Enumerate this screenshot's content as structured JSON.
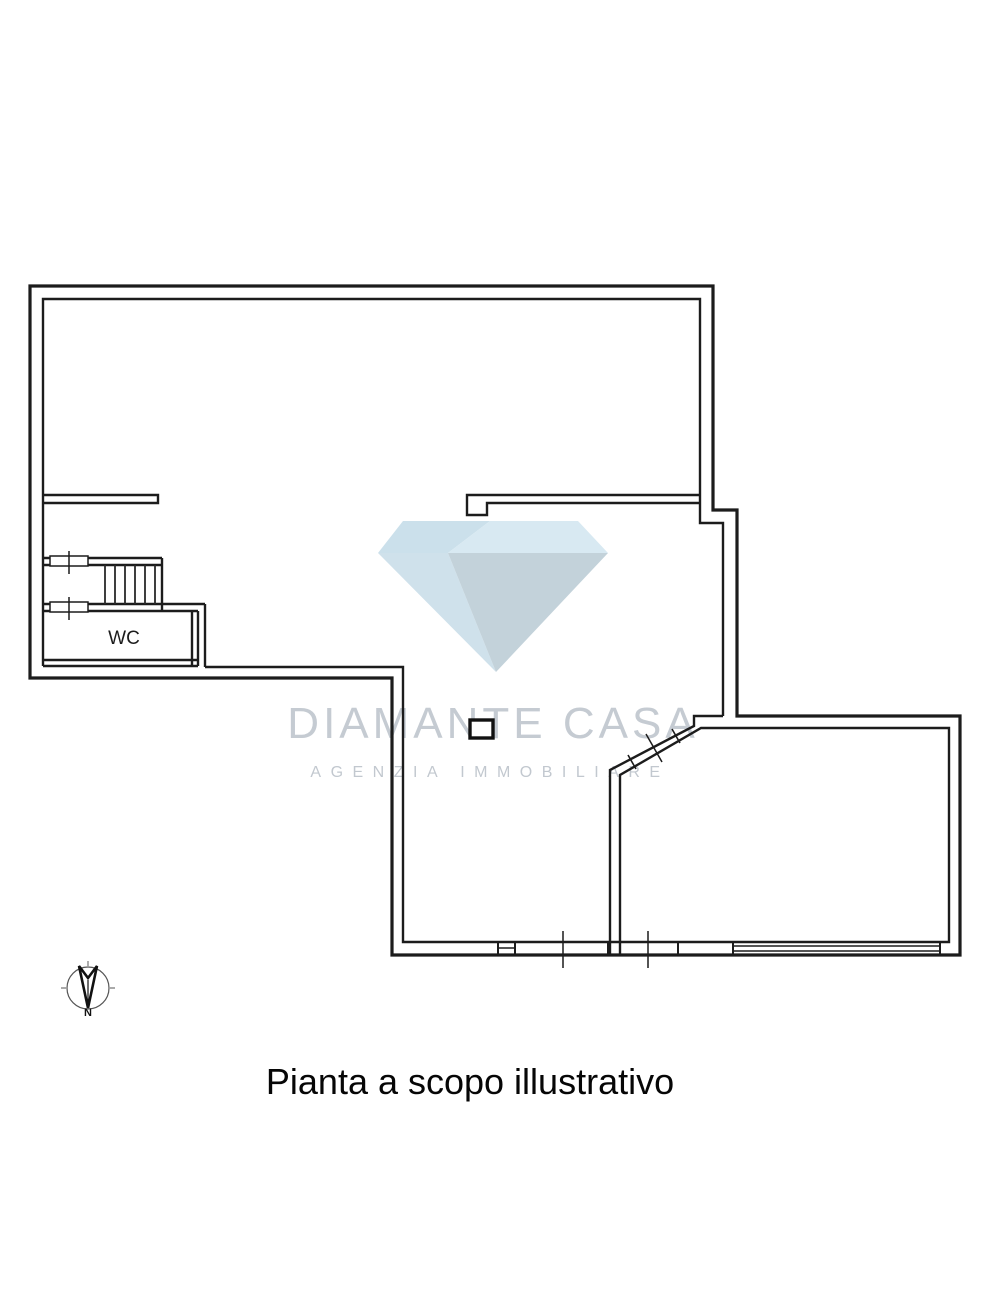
{
  "caption": "Pianta a scopo illustrativo",
  "watermark": {
    "brand": "DIAMANTE CASA",
    "tagline": "AGENZIA IMMOBILIARE"
  },
  "rooms": {
    "wc_label": "WC"
  },
  "compass": {
    "north_label": "N"
  },
  "colors": {
    "wall": "#1c1c1c",
    "watermark_text": "#c5cbd2",
    "diamond_top_left": "#cbe0eb",
    "diamond_top_right": "#d8e9f2",
    "diamond_pavilion_left": "#cfe1eb",
    "diamond_pavilion_right": "#c3d2da"
  }
}
